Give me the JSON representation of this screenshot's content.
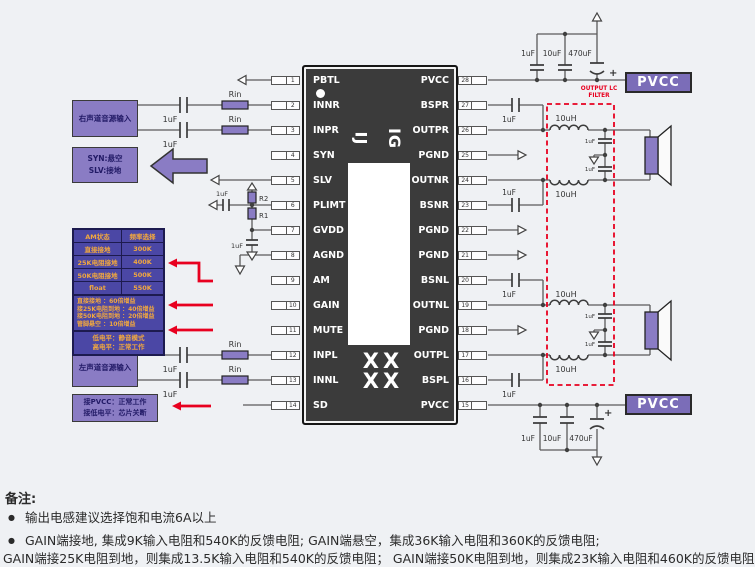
{
  "ic": {
    "left_pins": [
      {
        "num": "1",
        "name": "PBTL"
      },
      {
        "num": "2",
        "name": "INNR"
      },
      {
        "num": "3",
        "name": "INPR"
      },
      {
        "num": "4",
        "name": "SYN"
      },
      {
        "num": "5",
        "name": "SLV"
      },
      {
        "num": "6",
        "name": "PLIMT"
      },
      {
        "num": "7",
        "name": "GVDD"
      },
      {
        "num": "8",
        "name": "AGND"
      },
      {
        "num": "9",
        "name": "AM"
      },
      {
        "num": "10",
        "name": "GAIN"
      },
      {
        "num": "11",
        "name": "MUTE"
      },
      {
        "num": "12",
        "name": "INPL"
      },
      {
        "num": "13",
        "name": "INNL"
      },
      {
        "num": "14",
        "name": "SD"
      }
    ],
    "right_pins": [
      {
        "num": "28",
        "name": "PVCC"
      },
      {
        "num": "27",
        "name": "BSPR"
      },
      {
        "num": "26",
        "name": "OUTPR"
      },
      {
        "num": "25",
        "name": "PGND"
      },
      {
        "num": "24",
        "name": "OUTNR"
      },
      {
        "num": "23",
        "name": "BSNR"
      },
      {
        "num": "22",
        "name": "PGND"
      },
      {
        "num": "21",
        "name": "PGND"
      },
      {
        "num": "20",
        "name": "BSNL"
      },
      {
        "num": "19",
        "name": "OUTNL"
      },
      {
        "num": "18",
        "name": "PGND"
      },
      {
        "num": "17",
        "name": "OUTPL"
      },
      {
        "num": "16",
        "name": "BSPL"
      },
      {
        "num": "15",
        "name": "PVCC"
      }
    ],
    "marking_left": "IJ",
    "marking_right": "IG",
    "marking_bottom_row1": "XX",
    "marking_bottom_row2": "XX"
  },
  "left_side": {
    "right_channel_input": "右声道音源输入",
    "syn_slv_note_line1": "SYN:悬空",
    "syn_slv_note_line2": "SLV:接地",
    "left_channel_input": "左声道音源输入",
    "sd_note_line1": "接PVCC：正常工作",
    "sd_note_line2": "接低电平：芯片关断",
    "rin_label": "Rin",
    "r1_label": "R1",
    "r2_label": "R2",
    "cap_1uf": "1uF"
  },
  "am_gain_table": {
    "header_col1": "AM状态",
    "header_col2": "频率选择",
    "freq_rows": [
      [
        "直接接地",
        "300K"
      ],
      [
        "25K电阻接地",
        "400K"
      ],
      [
        "50K电阻接地",
        "500K"
      ],
      [
        "float",
        "550K"
      ]
    ],
    "gain_rows": [
      "直接接地 ：60倍增益",
      "接25K电阻到地 ：40倍增益",
      "接50K电阻到地 ：20倍增益",
      "管脚悬空 ：10倍增益"
    ],
    "mute_rows": [
      "低电平：静音模式",
      "高电平：正常工作"
    ]
  },
  "right_side": {
    "pvcc_top": "PVCC",
    "pvcc_bottom": "PVCC",
    "output_filter_label_line1": "OUTPUT LC",
    "output_filter_label_line2": "FILTER",
    "cap_1uf": "1uF",
    "cap_10uf": "10uF",
    "cap_470uf": "470uF",
    "inductor_10uh": "10uH",
    "plus_sign": "+"
  },
  "notes": {
    "title": "备注:",
    "bullet1": "输出电感建议选择饱和电流6A以上",
    "bullet2": "GAIN端接地, 集成9K输入电阻和540K的反馈电阻; GAIN端悬空，集成36K输入电阻和360K的反馈电阻;",
    "line3": "GAIN端接25K电阻到地，则集成13.5K输入电阻和540K的反馈电阻； GAIN端接50K电阻到地，则集成23K输入电阻和460K的反馈电阻"
  },
  "colors": {
    "accent_purple": "#8a7cc4",
    "pvcc_purple": "#7b6db8",
    "table_bg": "#4b47a5",
    "table_text": "#f2a83e",
    "red": "#e8001f",
    "ic_body": "#3b3b3b",
    "background": "#eff1f4"
  }
}
